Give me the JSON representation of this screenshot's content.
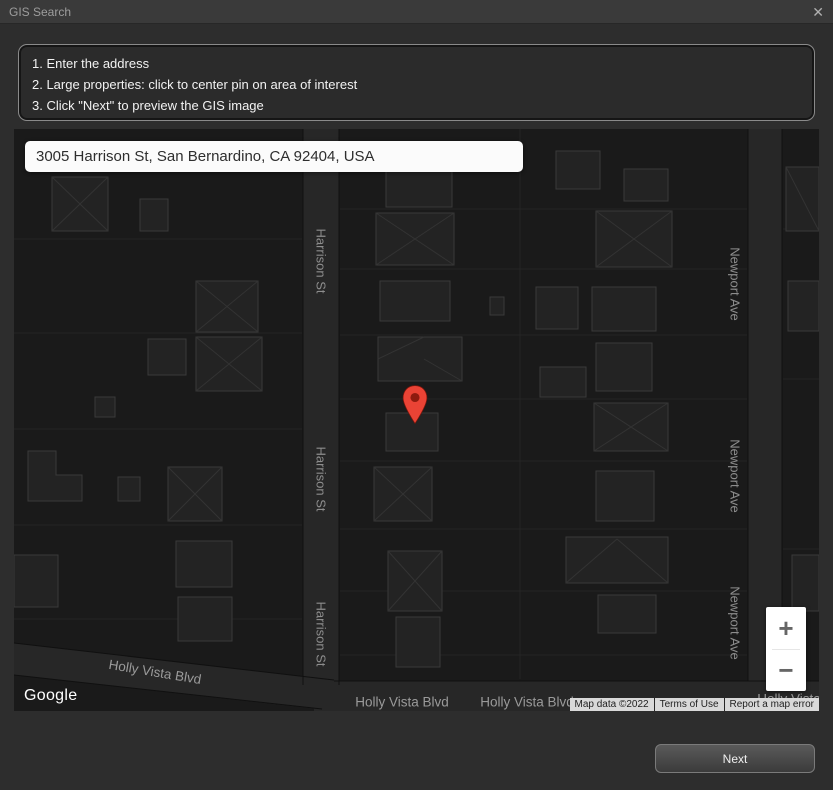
{
  "window": {
    "title": "GIS Search",
    "close_icon": "✕"
  },
  "instructions": {
    "line1": "1. Enter the address",
    "line2": "2. Large properties: click to center pin on area of interest",
    "line3": "3. Click \"Next\" to preview the GIS image"
  },
  "map": {
    "address": "3005 Harrison St, San Bernardino, CA 92404, USA",
    "labels": {
      "harrison": "Harrison St",
      "newport": "Newport Ave",
      "holly": "Holly Vista Blvd"
    },
    "google_logo": "Google",
    "attribution": {
      "map_data": "Map data ©2022",
      "terms": "Terms of Use",
      "report": "Report a map error"
    },
    "zoom_in": "+",
    "zoom_out": "−",
    "pin_color": "#EA4335",
    "pin_dot_color": "#8E1B0F"
  },
  "footer": {
    "next_label": "Next"
  }
}
